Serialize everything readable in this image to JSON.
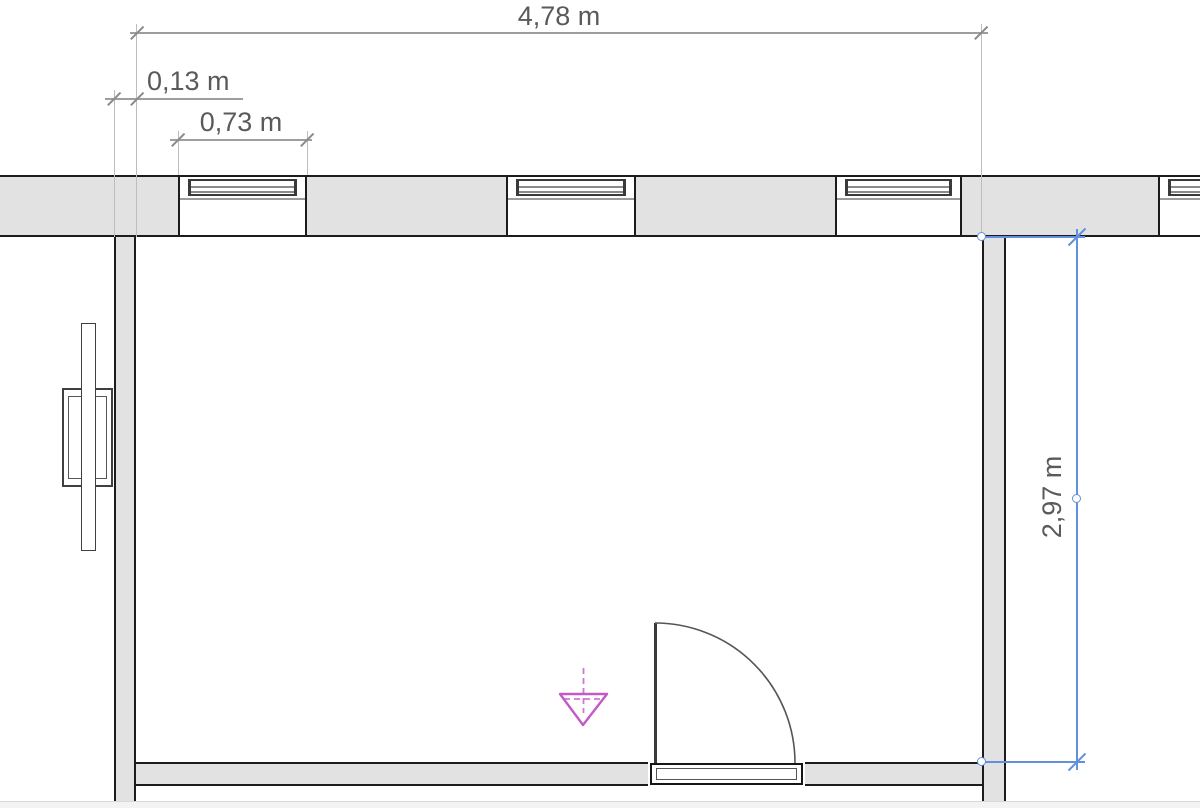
{
  "plan": {
    "dimensions": {
      "room_width": "4,78 m",
      "wall_offset": "0,13 m",
      "window_width": "0,73 m",
      "room_depth": "2,97 m"
    },
    "colors": {
      "wall_fill": "#e2e2e2",
      "wall_edge": "#1c1c1c",
      "dimension_line": "#9e9e9e",
      "dimension_text": "#5a5a5a",
      "selection_blue": "#6290de",
      "viewpoint_magenta": "#c35bc7"
    }
  }
}
